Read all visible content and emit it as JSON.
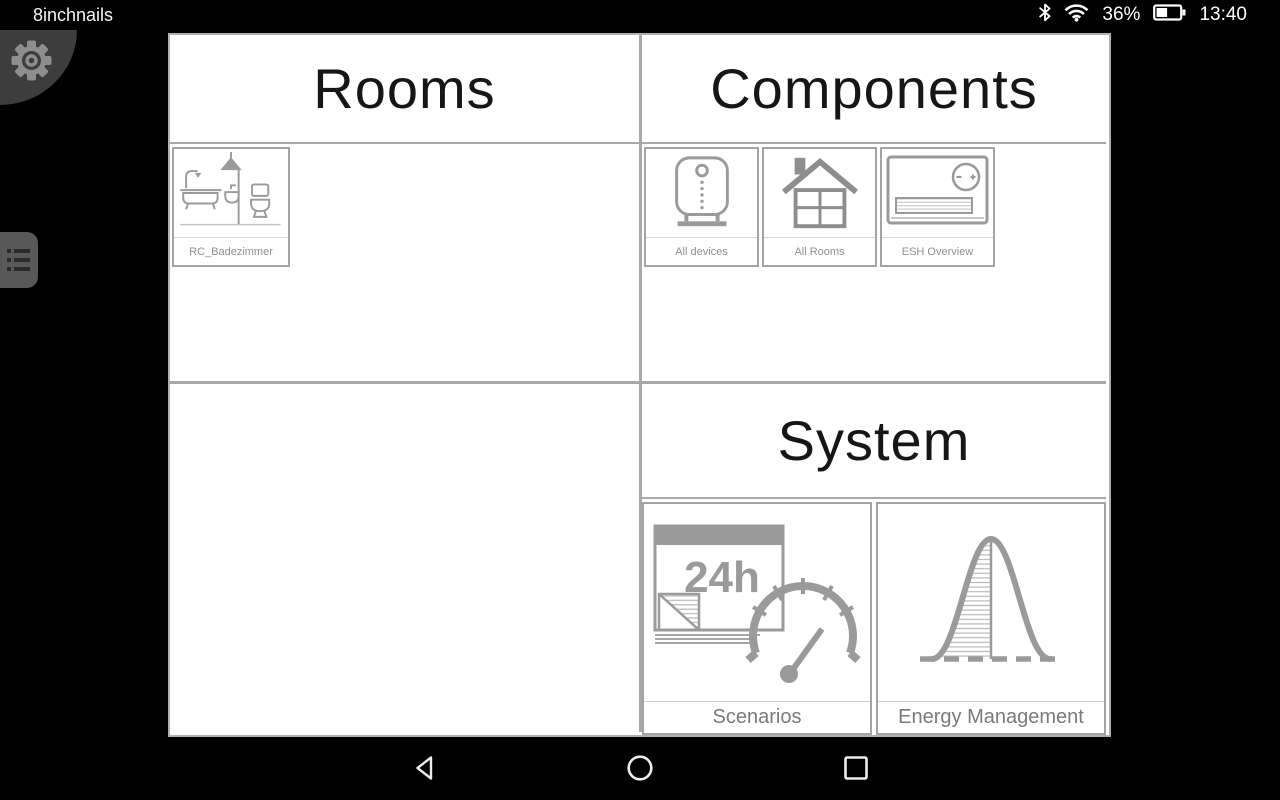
{
  "status_bar": {
    "carrier": "8inchnails",
    "battery_percent": "36%",
    "time": "13:40",
    "icons": [
      "bluetooth-icon",
      "wifi-icon",
      "battery-icon"
    ]
  },
  "side_controls": {
    "settings": "gear-icon",
    "menu": "list-menu-icon"
  },
  "sections": {
    "rooms": {
      "title": "Rooms",
      "tiles": [
        {
          "label": "RC_Badezimmer",
          "icon": "bathroom-icon"
        }
      ]
    },
    "components": {
      "title": "Components",
      "tiles": [
        {
          "label": "All devices",
          "icon": "device-box-icon"
        },
        {
          "label": "All Rooms",
          "icon": "house-icon"
        },
        {
          "label": "ESH Overview",
          "icon": "heater-thermostat-icon"
        }
      ]
    },
    "system": {
      "title": "System",
      "tiles": [
        {
          "label": "Scenarios",
          "icon": "calendar-24h-gauge-icon",
          "icon_text": "24h"
        },
        {
          "label": "Energy Management",
          "icon": "bell-curve-icon"
        }
      ]
    }
  },
  "nav_bar": {
    "buttons": [
      "back",
      "home",
      "recents"
    ]
  },
  "colors": {
    "panel_border": "#a8a8a8",
    "tile_border": "#a3a3a3",
    "icon_gray": "#9a9a9a",
    "label_gray": "#8f8f8f",
    "header_text": "#161616",
    "statusbar_bg": "#000000",
    "fab_bg": "#3d3d3d"
  }
}
